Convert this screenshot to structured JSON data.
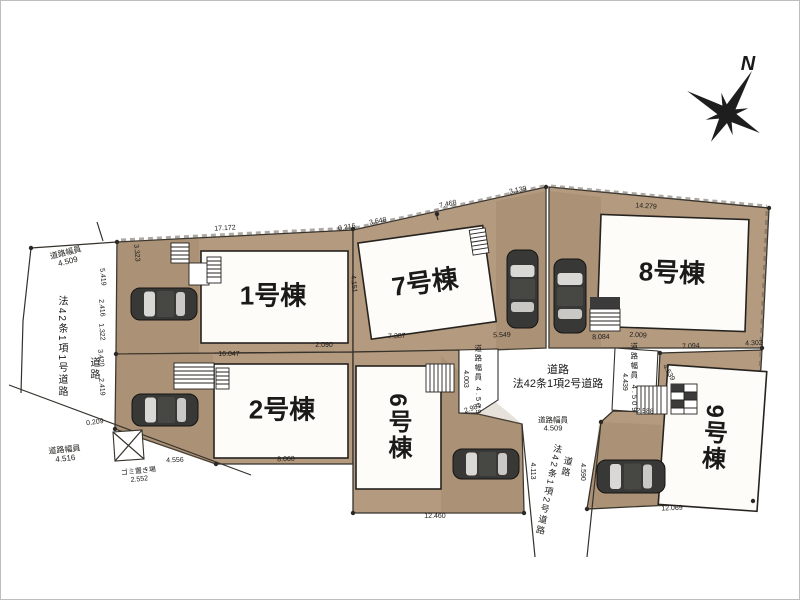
{
  "meta": {
    "type": "real-estate-site-plan",
    "units_visible": [
      "1号棟",
      "2号棟",
      "6号棟",
      "7号棟",
      "8号棟",
      "9号棟"
    ]
  },
  "colors": {
    "ground": "#b49a7f",
    "line": "#35312b",
    "text": "#1b1a18",
    "car": "#383836",
    "building": "#fdfcf9"
  },
  "compass": {
    "label": "N"
  },
  "labels": [
    {
      "name": "lot1-label",
      "text": "1号棟",
      "x": 272,
      "y": 295,
      "size": 26,
      "bold": true
    },
    {
      "name": "lot2-label",
      "text": "2号棟",
      "x": 281,
      "y": 409,
      "size": 26,
      "bold": true
    },
    {
      "name": "lot7-label",
      "text": "7号棟",
      "x": 424,
      "y": 282,
      "rot": -8,
      "size": 26,
      "bold": true
    },
    {
      "name": "lot8-label",
      "text": "8号棟",
      "x": 671,
      "y": 272,
      "rot": 2,
      "size": 26,
      "bold": true
    },
    {
      "name": "lot6-label",
      "text": "6号棟",
      "x": 396,
      "y": 426,
      "size": 24,
      "bold": true,
      "vertical": true
    },
    {
      "name": "lot9-label",
      "text": "9号棟",
      "x": 711,
      "y": 437,
      "rot": 4,
      "size": 24,
      "bold": true,
      "vertical": true
    },
    {
      "name": "road-left-width-top",
      "text": "道路幅員\n4.509",
      "x": 66,
      "y": 257,
      "rot": -14,
      "size": 8
    },
    {
      "name": "road-left-name",
      "text": "法42条1項1号道路",
      "x": 60,
      "y": 346,
      "size": 10,
      "vertical": true
    },
    {
      "name": "road-left-label",
      "text": "道路",
      "x": 92,
      "y": 368,
      "size": 10,
      "vertical": true
    },
    {
      "name": "road-left-width-bottom",
      "text": "道路幅員\n4.516",
      "x": 64,
      "y": 454,
      "rot": -6,
      "size": 8
    },
    {
      "name": "garbage-area-label",
      "text": "ゴミ置き場\n2.552",
      "x": 138,
      "y": 475,
      "rot": -6,
      "size": 7
    },
    {
      "name": "road-center-label",
      "text": "道路",
      "x": 557,
      "y": 369,
      "size": 11
    },
    {
      "name": "road-center-name",
      "text": "法42条1項2号道路",
      "x": 557,
      "y": 383,
      "size": 11
    },
    {
      "name": "road-center-width",
      "text": "道路幅員\n4.509",
      "x": 552,
      "y": 424,
      "size": 7.5
    },
    {
      "name": "road-pentagon-width",
      "text": "道路幅員 4.509",
      "x": 477,
      "y": 379,
      "size": 7.5,
      "vertical": true
    },
    {
      "name": "road-box-width",
      "text": "道路幅員 4.509",
      "x": 633,
      "y": 377,
      "size": 7.5,
      "vertical": true
    },
    {
      "name": "road-south-name",
      "text": "法42条1項2号道路",
      "x": 547,
      "y": 489,
      "rot": 12,
      "size": 9,
      "vertical": true
    },
    {
      "name": "road-south-label",
      "text": "道路",
      "x": 565,
      "y": 466,
      "rot": 12,
      "size": 9,
      "vertical": true
    },
    {
      "name": "compass-label",
      "text": "N",
      "x": 747,
      "y": 63,
      "size": 20,
      "bold": true,
      "italic": true
    }
  ],
  "dimensions": [
    {
      "text": "17.172",
      "x": 224,
      "y": 228,
      "rot": -3
    },
    {
      "text": "0.216",
      "x": 346,
      "y": 227,
      "rot": -10
    },
    {
      "text": "3.648",
      "x": 377,
      "y": 221,
      "rot": -11
    },
    {
      "text": "7.468",
      "x": 447,
      "y": 204,
      "rot": -12
    },
    {
      "text": "3.139",
      "x": 517,
      "y": 190,
      "rot": -12
    },
    {
      "text": "14.279",
      "x": 645,
      "y": 206,
      "rot": 4
    },
    {
      "text": "16.047",
      "x": 228,
      "y": 354,
      "rot": 0
    },
    {
      "text": "2.090",
      "x": 323,
      "y": 345,
      "rot": 0
    },
    {
      "text": "7.387",
      "x": 396,
      "y": 336,
      "rot": -3
    },
    {
      "text": "5.549",
      "x": 501,
      "y": 335,
      "rot": -2
    },
    {
      "text": "8.084",
      "x": 600,
      "y": 337,
      "rot": -2
    },
    {
      "text": "2.009",
      "x": 637,
      "y": 335,
      "rot": 3
    },
    {
      "text": "7.094",
      "x": 690,
      "y": 346,
      "rot": -3
    },
    {
      "text": "4.302",
      "x": 753,
      "y": 343,
      "rot": -3
    },
    {
      "text": "4.539",
      "x": 667,
      "y": 372,
      "rot": 60
    },
    {
      "text": "4.439",
      "x": 623,
      "y": 381,
      "rot": 90
    },
    {
      "text": "2.588",
      "x": 644,
      "y": 411,
      "rot": 3
    },
    {
      "text": "4.003",
      "x": 464,
      "y": 378,
      "rot": 90
    },
    {
      "text": "2.981",
      "x": 472,
      "y": 408,
      "rot": -20
    },
    {
      "text": "4.556",
      "x": 174,
      "y": 460,
      "rot": -2
    },
    {
      "text": "8.060",
      "x": 285,
      "y": 459,
      "rot": -2
    },
    {
      "text": "12.460",
      "x": 434,
      "y": 516,
      "rot": 0
    },
    {
      "text": "12.069",
      "x": 671,
      "y": 508,
      "rot": -2
    },
    {
      "text": "4.113",
      "x": 531,
      "y": 470,
      "rot": 90
    },
    {
      "text": "4.590",
      "x": 581,
      "y": 471,
      "rot": 90
    },
    {
      "text": "0.209",
      "x": 94,
      "y": 422,
      "rot": -8
    },
    {
      "text": "2.419",
      "x": 100,
      "y": 386,
      "rot": 85
    },
    {
      "text": "3.420",
      "x": 99,
      "y": 357,
      "rot": 85
    },
    {
      "text": "1.322",
      "x": 100,
      "y": 331,
      "rot": 85
    },
    {
      "text": "2.416",
      "x": 100,
      "y": 307,
      "rot": 85
    },
    {
      "text": "5.419",
      "x": 101,
      "y": 276,
      "rot": 85
    },
    {
      "text": "3.323",
      "x": 135,
      "y": 252,
      "rot": 85
    },
    {
      "text": "4.151",
      "x": 352,
      "y": 283,
      "rot": 85
    }
  ]
}
